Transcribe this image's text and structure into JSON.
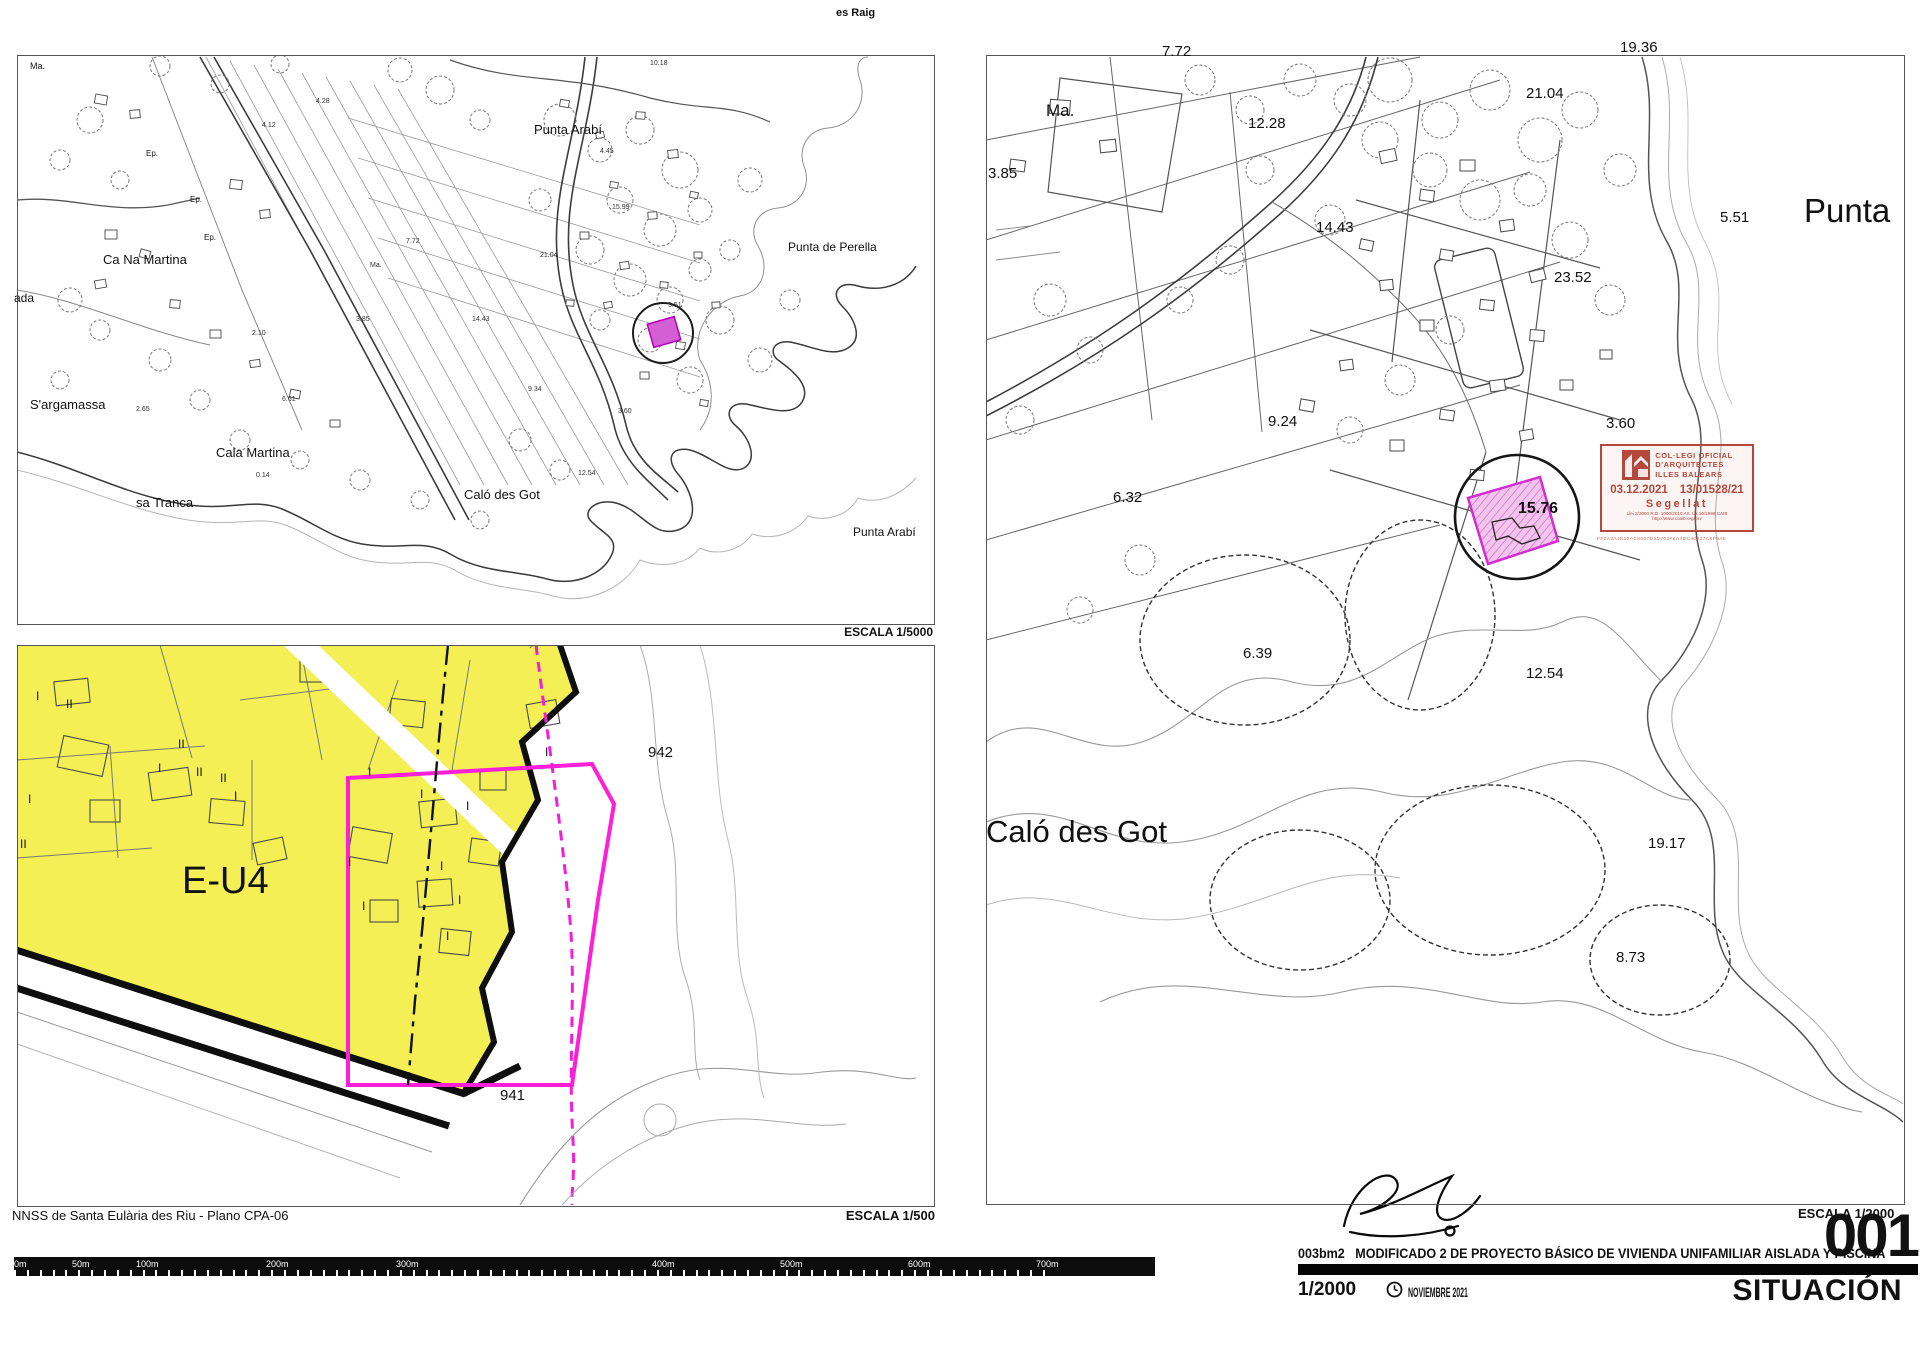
{
  "page": {
    "background": "#ffffff",
    "accent_magenta": "#e522d4",
    "accent_yellow": "#f4ef55",
    "stamp_red": "#b5473c"
  },
  "map5000": {
    "escala_label": "ESCALA  1/5000",
    "place_labels": [
      {
        "t": "es Raig",
        "x": 836,
        "y": 8,
        "s": 11,
        "b": 1
      },
      {
        "t": "Ma.",
        "x": 30,
        "y": 62,
        "s": 9
      },
      {
        "t": "Ca Na Martina",
        "x": 103,
        "y": 253,
        "s": 13
      },
      {
        "t": "ada",
        "x": 14,
        "y": 292,
        "s": 12
      },
      {
        "t": "Ep.",
        "x": 146,
        "y": 150,
        "s": 8
      },
      {
        "t": "Ep.",
        "x": 190,
        "y": 196,
        "s": 8
      },
      {
        "t": "Ep.",
        "x": 204,
        "y": 234,
        "s": 8
      },
      {
        "t": "S'argamassa",
        "x": 30,
        "y": 398,
        "s": 13
      },
      {
        "t": "sa Tranca",
        "x": 136,
        "y": 496,
        "s": 13
      },
      {
        "t": "Cala Martina",
        "x": 216,
        "y": 446,
        "s": 13
      },
      {
        "t": "Caló des Got",
        "x": 464,
        "y": 488,
        "s": 13
      },
      {
        "t": "Punta Arabí",
        "x": 534,
        "y": 123,
        "s": 13
      },
      {
        "t": "Punta de Perella",
        "x": 788,
        "y": 241,
        "s": 12
      },
      {
        "t": "Punta Arabí",
        "x": 853,
        "y": 526,
        "s": 12
      }
    ],
    "spot_heights": [
      {
        "t": "10.18",
        "x": 650,
        "y": 60
      },
      {
        "t": "4.45",
        "x": 600,
        "y": 148
      },
      {
        "t": "15.99",
        "x": 612,
        "y": 204
      },
      {
        "t": "4.28",
        "x": 316,
        "y": 98
      },
      {
        "t": "4.12",
        "x": 262,
        "y": 122
      },
      {
        "t": "7.72",
        "x": 406,
        "y": 238
      },
      {
        "t": "Ma.",
        "x": 370,
        "y": 262
      },
      {
        "t": "3.85",
        "x": 356,
        "y": 316
      },
      {
        "t": "2.10",
        "x": 252,
        "y": 330
      },
      {
        "t": "6.61",
        "x": 282,
        "y": 396
      },
      {
        "t": "14.43",
        "x": 472,
        "y": 316
      },
      {
        "t": "21.04",
        "x": 540,
        "y": 252
      },
      {
        "t": "5.51",
        "x": 668,
        "y": 302
      },
      {
        "t": "9.34",
        "x": 528,
        "y": 386
      },
      {
        "t": "3.60",
        "x": 618,
        "y": 408
      },
      {
        "t": "12.54",
        "x": 578,
        "y": 470
      },
      {
        "t": "0.14",
        "x": 256,
        "y": 472
      },
      {
        "t": "2.65",
        "x": 136,
        "y": 406
      }
    ]
  },
  "map500": {
    "zone_label": "E-U4",
    "upper_parcel_number": "942",
    "lower_parcel_number": "941",
    "source_label": "NNSS de Santa Eulària des Riu - Plano CPA-06",
    "escala_label": "ESCALA  1/500",
    "storey_marks": [
      {
        "t": "I",
        "x": 36,
        "y": 690
      },
      {
        "t": "II",
        "x": 66,
        "y": 698
      },
      {
        "t": "I",
        "x": 28,
        "y": 793
      },
      {
        "t": "II",
        "x": 178,
        "y": 738
      },
      {
        "t": "I",
        "x": 158,
        "y": 762
      },
      {
        "t": "II",
        "x": 196,
        "y": 766
      },
      {
        "t": "II",
        "x": 220,
        "y": 772
      },
      {
        "t": "I",
        "x": 234,
        "y": 790
      },
      {
        "t": "II",
        "x": 20,
        "y": 838
      },
      {
        "t": "I",
        "x": 368,
        "y": 766
      },
      {
        "t": "I",
        "x": 420,
        "y": 788
      },
      {
        "t": "I",
        "x": 466,
        "y": 800
      },
      {
        "t": "I",
        "x": 348,
        "y": 856
      },
      {
        "t": "I",
        "x": 362,
        "y": 900
      },
      {
        "t": "I",
        "x": 440,
        "y": 860
      },
      {
        "t": "I",
        "x": 458,
        "y": 894
      },
      {
        "t": "I",
        "x": 446,
        "y": 930
      },
      {
        "t": "I",
        "x": 545,
        "y": 746
      }
    ]
  },
  "map2000": {
    "escala_label": "ESCALA  1/2000",
    "place_labels": [
      {
        "t": "Punta",
        "x": 1804,
        "y": 194,
        "s": 33
      },
      {
        "t": "Caló des Got",
        "x": 986,
        "y": 816,
        "s": 31
      }
    ],
    "spot_heights": [
      {
        "t": "7.72",
        "x": 1162,
        "y": 44,
        "s": 15
      },
      {
        "t": "19.36",
        "x": 1620,
        "y": 40,
        "s": 15
      },
      {
        "t": "21.04",
        "x": 1526,
        "y": 86,
        "s": 15
      },
      {
        "t": "12.28",
        "x": 1248,
        "y": 116,
        "s": 15
      },
      {
        "t": "Ma.",
        "x": 1046,
        "y": 102,
        "s": 17
      },
      {
        "t": "3.85",
        "x": 988,
        "y": 166,
        "s": 15
      },
      {
        "t": "14.43",
        "x": 1316,
        "y": 220,
        "s": 15
      },
      {
        "t": "23.52",
        "x": 1554,
        "y": 270,
        "s": 15
      },
      {
        "t": "5.51",
        "x": 1720,
        "y": 210,
        "s": 15
      },
      {
        "t": "9.24",
        "x": 1268,
        "y": 414,
        "s": 15
      },
      {
        "t": "3.60",
        "x": 1606,
        "y": 416,
        "s": 15
      },
      {
        "t": "6.32",
        "x": 1113,
        "y": 490,
        "s": 15
      },
      {
        "t": "15.76",
        "x": 1518,
        "y": 501,
        "s": 16,
        "b": 1
      },
      {
        "t": "6.39",
        "x": 1243,
        "y": 646,
        "s": 15
      },
      {
        "t": "12.54",
        "x": 1526,
        "y": 666,
        "s": 15
      },
      {
        "t": "19.17",
        "x": 1648,
        "y": 836,
        "s": 15
      },
      {
        "t": "8.73",
        "x": 1616,
        "y": 950,
        "s": 15
      }
    ],
    "stamp": {
      "org_line1": "COL·LEGI  OFICIAL",
      "org_line2": "D'ARQUITECTES",
      "org_line3": "ILLES  BALEARS",
      "date": "03.12.2021",
      "file_number": "13/01528/21",
      "status": "Segellat",
      "legal": "Llei 2/2000  R.D. 1000/2010 Art.  Ús 10/1998 CAIB",
      "url": "http://www.coaib.org/csv",
      "hash": "FF0A3A4E12AC8087D4D702F6A4DC40027C6P9A5"
    }
  },
  "scalebar": {
    "tick_labels": [
      {
        "t": "0m",
        "x": 16
      },
      {
        "t": "50m",
        "x": 74
      },
      {
        "t": "100m",
        "x": 138
      },
      {
        "t": "200m",
        "x": 268
      },
      {
        "t": "300m",
        "x": 398
      },
      {
        "t": "400m",
        "x": 654
      },
      {
        "t": "500m",
        "x": 782
      },
      {
        "t": "600m",
        "x": 910
      },
      {
        "t": "700m",
        "x": 1038
      }
    ]
  },
  "titleblock": {
    "project_code": "003bm2",
    "project_title": "MODIFICADO 2 DE PROYECTO BÁSICO DE VIVIENDA UNIFAMILIAR AISLADA Y PISCINA",
    "scale_value": "1/2000",
    "date_value": "NOVIEMBRE 2021",
    "sheet_number": "001",
    "sheet_title": "SITUACIÓN",
    "escala_label": "ESCALA  1/2000"
  }
}
